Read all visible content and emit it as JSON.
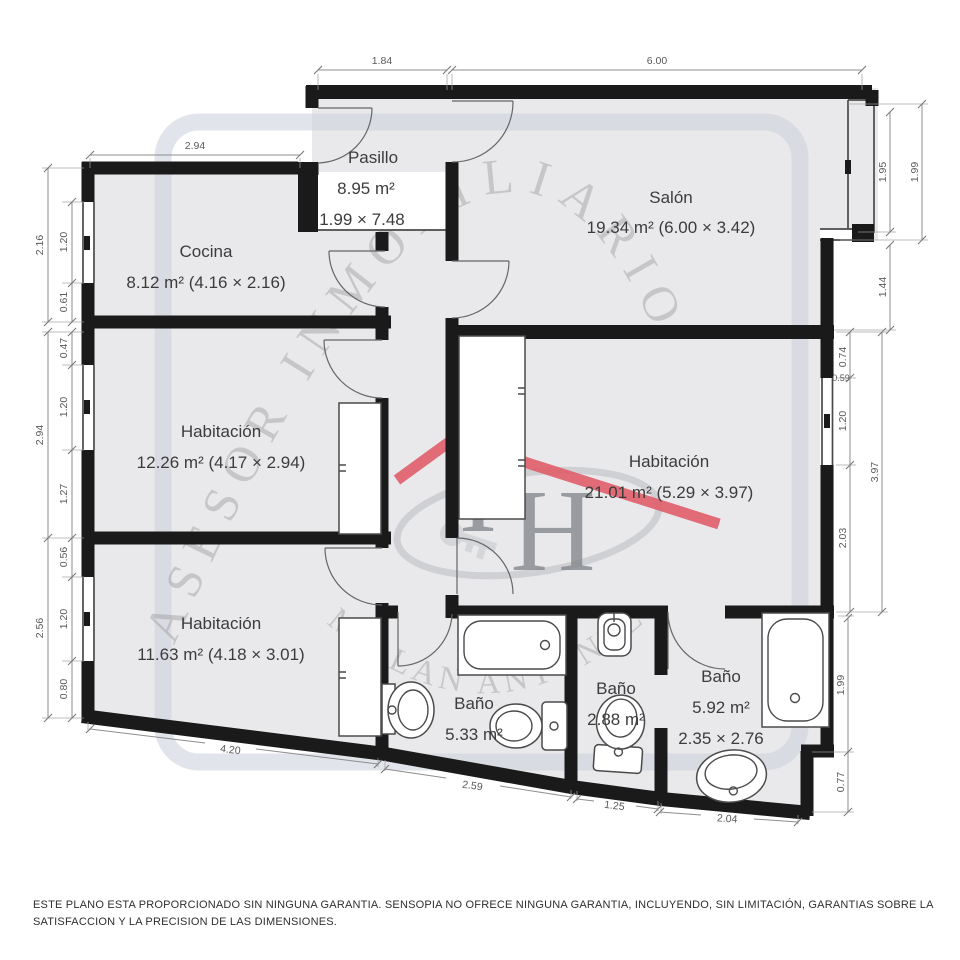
{
  "watermark": {
    "arc_top": "ASESOR INMOBILIARIO",
    "arc_bottom": "MILLAN ANTUNEZ",
    "logo_i": "I",
    "logo_h": "H"
  },
  "rooms": [
    {
      "name": "Pasillo",
      "area": "8.95 m²",
      "size": "1.99 × 7.48"
    },
    {
      "name": "Salón",
      "area": "19.34 m² (6.00 × 3.42)"
    },
    {
      "name": "Cocina",
      "area": "8.12 m² (4.16 × 2.16)"
    },
    {
      "name": "Habitación",
      "area": "12.26 m² (4.17 × 2.94)"
    },
    {
      "name": "Habitación",
      "area": "21.01 m² (5.29 × 3.97)"
    },
    {
      "name": "Habitación",
      "area": "11.63 m² (4.18 × 3.01)"
    },
    {
      "name": "Baño",
      "area": "5.33 m²"
    },
    {
      "name": "Baño",
      "area": "2.88 m²"
    },
    {
      "name": "Baño",
      "area": "5.92 m²",
      "size": "2.35 × 2.76"
    }
  ],
  "dimensions": {
    "top": [
      "1.84",
      "6.00"
    ],
    "top_left": "2.94",
    "left_outer": [
      "2.16",
      "2.94",
      "2.56"
    ],
    "left_inner": [
      "1.20",
      "0.61",
      "0.47",
      "1.20",
      "1.27",
      "0.56",
      "1.20",
      "0.80"
    ],
    "right_salon": [
      "1.95",
      "1.99",
      "1.44"
    ],
    "right_hab": [
      "0.74",
      "0.59",
      "1.20",
      "2.03",
      "3.97"
    ],
    "right_bath": [
      "1.99",
      "0.77"
    ],
    "bottom": [
      "4.20",
      "2.59",
      "1.25",
      "2.04"
    ]
  },
  "disclaimer": "ESTE PLANO ESTA PROPORCIONADO SIN NINGUNA GARANTIA. SENSOPIA NO OFRECE NINGUNA GARANTIA, INCLUYENDO, SIN LIMITACIÓN, GARANTIAS SOBRE LA SATISFACCION Y LA PRECISION DE LAS DIMENSIONES.",
  "colors": {
    "wall": "#1a1a1a",
    "floor": "#e9e9eb",
    "roof_accent": "#e0606b",
    "watermark_gray": "#8f9094",
    "dimension_gray": "#5a5a5a"
  }
}
